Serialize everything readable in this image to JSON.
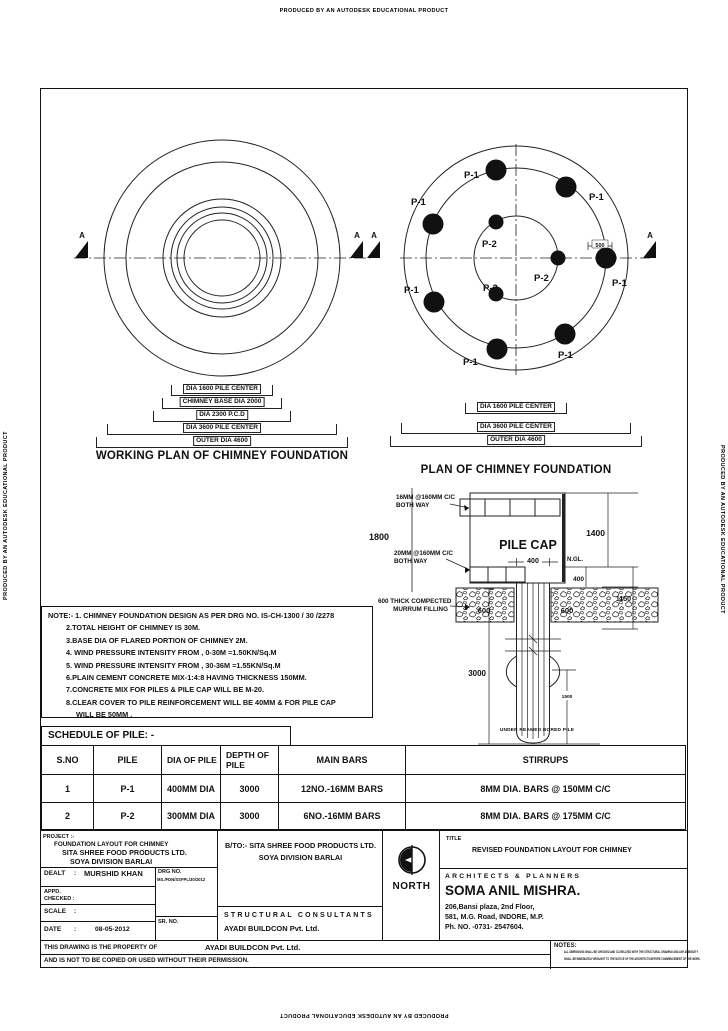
{
  "edge": {
    "autodesk": "PRODUCED BY AN AUTODESK EDUCATIONAL PRODUCT"
  },
  "working_plan": {
    "caption": "WORKING  PLAN OF CHIMNEY FOUNDATION",
    "marker": "A",
    "dims": [
      "DIA 1600 PILE CENTER",
      "CHIMNEY BASE  DIA 2000",
      "DIA 2300 P.C.D",
      "DIA 3600 PILE CENTER",
      "OUTER DIA 4600"
    ]
  },
  "pile_plan": {
    "caption": "PLAN OF CHIMNEY FOUNDATION",
    "marker": "A",
    "p1": "P-1",
    "p2": "P-2",
    "edge_dim": "500",
    "dims": [
      "DIA 1600 PILE CENTER",
      "DIA 3600 PILE CENTER",
      "OUTER DIA 4600"
    ]
  },
  "section": {
    "label_top_rebar_1": "16MM @160MM C/C",
    "label_top_rebar_2": "BOTH WAY",
    "label_bot_rebar_1": "20MM @160MM C/C",
    "label_bot_rebar_2": "BOTH WAY",
    "pile_cap": "PILE CAP",
    "ngl": "N.GL.",
    "murrum_1": "600 THICK COMPECTED",
    "murrum_2": "MURRUM FILLING",
    "dim_1800": "1800",
    "dim_1400": "1400",
    "dim_400_ngl": "400",
    "dim_400_pile": "400",
    "dim_1150": "1150",
    "dim_600_left": "600",
    "dim_600_right": "600",
    "dim_3000": "3000",
    "dim_1500": "1500",
    "caption": "UNDER REAMED BORED PILE"
  },
  "notes": {
    "lines": [
      "NOTE:- 1. CHIMNEY FOUNDATION  DESIGN AS PER DRG NO. IS-CH-1300 / 30 /2278",
      "2.TOTAL HEIGHT OF CHIMNEY IS 30M.",
      "3.BASE DIA OF FLARED PORTION OF CHIMNEY 2M.",
      "4. WIND PRESSURE INTENSITY FROM , 0-30M =1.50KN/Sq.M",
      "5. WIND PRESSURE INTENSITY FROM , 30-36M =1.55KN/Sq.M",
      "6.PLAIN CEMENT CONCRETE MIX-1:4:8 HAVING THICKNESS 150MM.",
      "7.CONCRETE MIX FOR PILES & PILE CAP WILL BE M-20.",
      "8.CLEAR COVER TO PILE REINFORCEMENT WILL BE 40MM & FOR PILE CAP",
      "WILL BE 50MM ."
    ]
  },
  "schedule": {
    "title": "SCHEDULE OF PILE: -",
    "headers": [
      "S.NO",
      "PILE",
      "DIA OF PILE",
      "DEPTH OF PILE",
      "MAIN BARS",
      "STIRRUPS"
    ],
    "rows": [
      {
        "sno": "1",
        "pile": "P-1",
        "dia": "400MM DIA",
        "depth": "3000",
        "main_bars": "12NO.-16MM BARS",
        "stirrups": "8MM DIA. BARS @ 150MM C/C"
      },
      {
        "sno": "2",
        "pile": "P-2",
        "dia": "300MM DIA",
        "depth": "3000",
        "main_bars": "6NO.-16MM BARS",
        "stirrups": "8MM DIA. BARS @ 175MM C/C"
      }
    ]
  },
  "titleblock": {
    "project_label": "PROJECT :-",
    "project_line1": "FOUNDATION LAYOUT FOR CHIMNEY",
    "project_line2": "SITA SHREE FOOD PRODUCTS LTD.",
    "project_line3": "SOYA DIVISION BARLAI",
    "colon": ":",
    "dealt_label": "DEALT",
    "dealt_value": "MURSHID KHAN",
    "drg_label": "DRG NO.",
    "drg_value": "MS./FDN/SSFPL/30/2012",
    "appd_label": "APPD.",
    "checked_label": "CHECKED :",
    "scale_label": "SCALE",
    "date_label": "DATE",
    "date_value": "08-05-2012",
    "srno_label": "SR. NO.",
    "bto_line1": "B/TO:- SITA SHREE FOOD PRODUCTS LTD.",
    "bto_line2": "SOYA DIVISION BARLAI",
    "consultants_label": "STRUCTURAL CONSULTANTS",
    "consultants_name": "AYADI BUILDCON Pvt. Ltd.",
    "north_label": "NORTH",
    "title_label": "TITLE",
    "drawing_title": "REVISED FOUNDATION LAYOUT FOR CHIMNEY",
    "architects_label": "ARCHITECTS & PLANNERS",
    "architect_name": "SOMA ANIL MISHRA.",
    "address1": "206,Bansi plaza, 2nd Floor,",
    "address2": "581, M.G. Road, INDORE, M.P.",
    "address3": "Ph. NO. -0731- 2547604."
  },
  "footer": {
    "property_line1_a": "THIS DRAWING IS THE PROPERTY OF",
    "property_line1_b": "AYADI BUILDCON Pvt. Ltd.",
    "property_line2": "AND IS NOT TO BE COPIED OR USED WITHOUT THEIR PERMISSION.",
    "notes_label": "NOTES:",
    "notes_line1": "ALL DIMENSIONS SHALL BE CHECKED AND CO-RELATED WITH THE STRUCTURAL DRAWING AND ANY AMBIGUITY",
    "notes_line2": "SHALL BE IMMEDIATELY BROUGHT TO THE NOTICE OF THE ARCHITECTS BEFORE COMMENCEMENT OF THE WORK."
  }
}
